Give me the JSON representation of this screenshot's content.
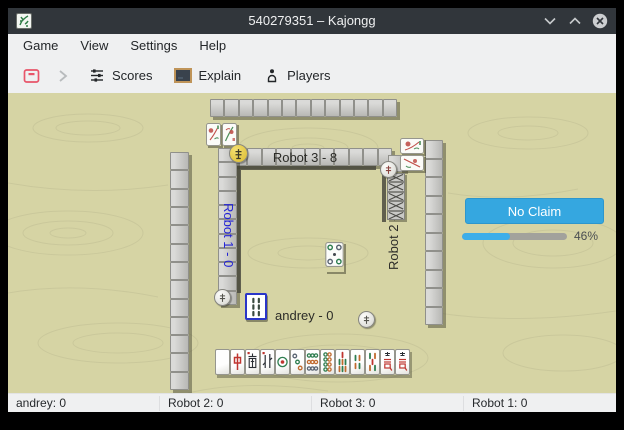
{
  "window": {
    "title": "540279351 – Kajongg"
  },
  "menubar": {
    "items": [
      {
        "label": "Game"
      },
      {
        "label": "View"
      },
      {
        "label": "Settings"
      },
      {
        "label": "Help"
      }
    ]
  },
  "toolbar": {
    "buttons": [
      {
        "name": "abort-game",
        "label": "",
        "icon": "red-window-minus-icon"
      },
      {
        "name": "step-forward",
        "label": "",
        "icon": "chevron-right-icon",
        "enabled": false
      },
      {
        "name": "scores",
        "label": "Scores",
        "icon": "scores-list-icon"
      },
      {
        "name": "explain",
        "label": "Explain",
        "icon": "blackboard-icon"
      },
      {
        "name": "players",
        "label": "Players",
        "icon": "player-icon"
      }
    ]
  },
  "board": {
    "players": {
      "top": {
        "name": "Robot 3",
        "label": "Robot 3 - 8"
      },
      "left": {
        "name": "Robot 1",
        "label": "Robot 1 - 0",
        "label_color": "#2323d6"
      },
      "right": {
        "name": "Robot 2",
        "label": "Robot 2 - 8"
      },
      "bottom": {
        "name": "andrey",
        "label": "andrey - 0"
      }
    },
    "walls": {
      "outer_top_tiles": 13,
      "outer_left_tiles": 13,
      "outer_right_tiles": 10,
      "top_hand_tiles": 12,
      "left_hand_tiles": 11,
      "right_concealed_tiles": 5
    },
    "bonus_tiles": {
      "robot3": [
        "flower",
        "flower"
      ],
      "robot2": [
        "flower",
        "flower"
      ]
    },
    "center": {
      "last_discard": "circle-5",
      "focused_discard": "bamboo-2"
    },
    "east_disc_color": "#e8c63e",
    "hand": [
      {
        "name": "white-dragon",
        "face": "blank"
      },
      {
        "name": "red-dragon",
        "face": "zhong"
      },
      {
        "name": "south-wind",
        "face": "nan"
      },
      {
        "name": "north-wind",
        "face": "bei"
      },
      {
        "name": "circle-1",
        "face": "c1"
      },
      {
        "name": "circle-3",
        "face": "c3"
      },
      {
        "name": "circle-9",
        "face": "c9"
      },
      {
        "name": "circle-8",
        "face": "c8"
      },
      {
        "name": "bamboo-7",
        "face": "b7"
      },
      {
        "name": "bamboo-4",
        "face": "b4"
      },
      {
        "name": "bamboo-5",
        "face": "b5"
      },
      {
        "name": "character-7",
        "face": "wan"
      },
      {
        "name": "character-9",
        "face": "wan"
      }
    ]
  },
  "panel": {
    "claim_button": "No Claim",
    "progress_percent": 46,
    "progress_label": "46%",
    "accent": "#3daee9"
  },
  "statusbar": {
    "items": [
      "andrey: 0",
      "Robot 2: 0",
      "Robot 3: 0",
      "Robot 1: 0"
    ]
  }
}
